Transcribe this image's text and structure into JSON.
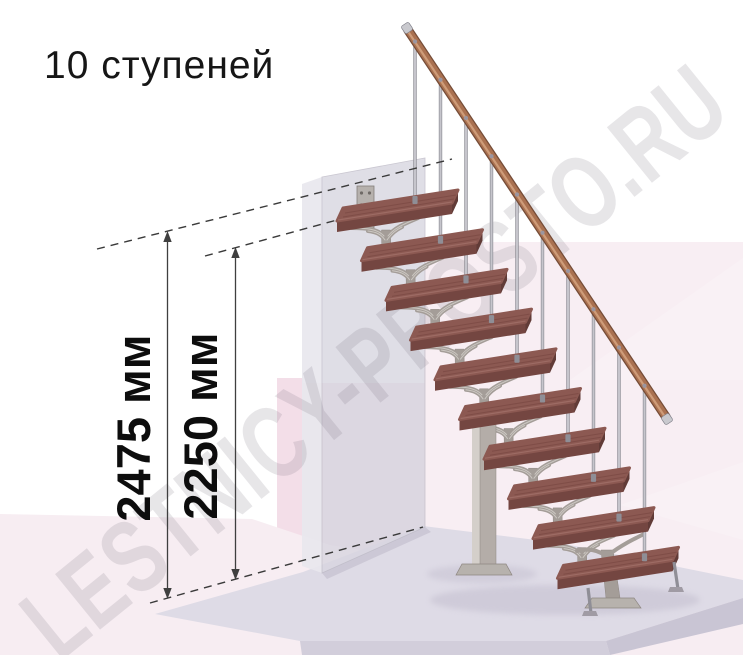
{
  "title": "10 ступеней",
  "watermark": "LESTNICY-PROSTO.RU",
  "dimensions": {
    "total_height": "2475 мм",
    "to_top_step": "2250 мм"
  },
  "staircase": {
    "steps_count": 10,
    "colors": {
      "tread_top": "#8c5952",
      "tread_grain": "#6e3f3a",
      "tread_highlight": "#a5746c",
      "tread_front": "#744641",
      "tread_side": "#613b37",
      "metal": "#a49d98",
      "metal_dark": "#8d8681",
      "metal_light": "#d6d2cd",
      "column_front": "#b4ada8",
      "column_light": "#d4cfca",
      "plate": "#b7b2ad",
      "baluster": "#c6c5cc",
      "baluster_edge": "#8f8e96",
      "handrail": "#aa7150",
      "handrail_dark": "#754c37",
      "handrail_light": "#d2a17e",
      "cap": "#c9c9ce",
      "wall": "#d8d6e0",
      "wall_side": "#e8e7ee",
      "floor": "#f7edf2",
      "slab": "#dedbe6",
      "slab_front": "#d2cedb",
      "dimension_line": "#3a3a3a"
    }
  }
}
